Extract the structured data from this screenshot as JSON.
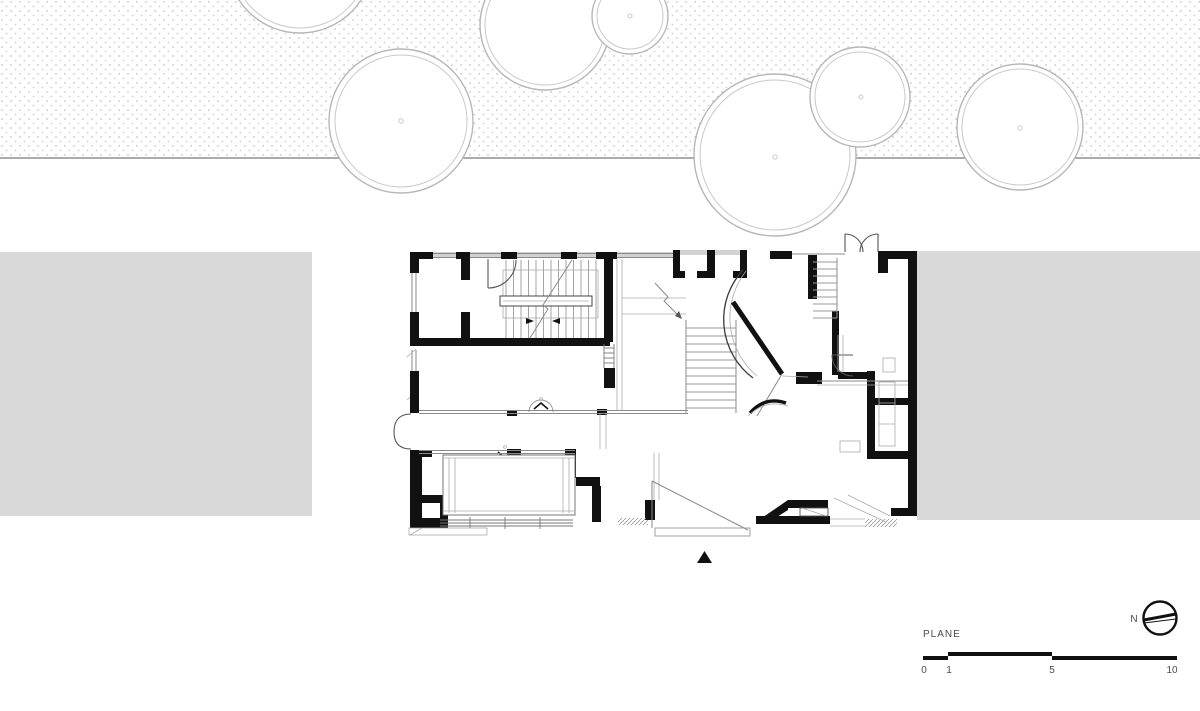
{
  "title_block": {
    "drawing_label": "PLANE",
    "north_label": "N",
    "scale_ticks": [
      "0",
      "1",
      "5",
      "10"
    ]
  },
  "drawing": {
    "type": "architectural-floor-plan",
    "features": "site band with trees, neighbouring buildings, ground floor plan with stairs, curved wall and entrance marker"
  },
  "colors": {
    "wall": "#111111",
    "site_block": "#d9d9d9",
    "dot": "#c4c4c4",
    "tree_stroke": "#b7b7b7",
    "thin_line": "#8a8a8a",
    "hatch": "#d2d2d2",
    "text": "#4a4a4a"
  }
}
